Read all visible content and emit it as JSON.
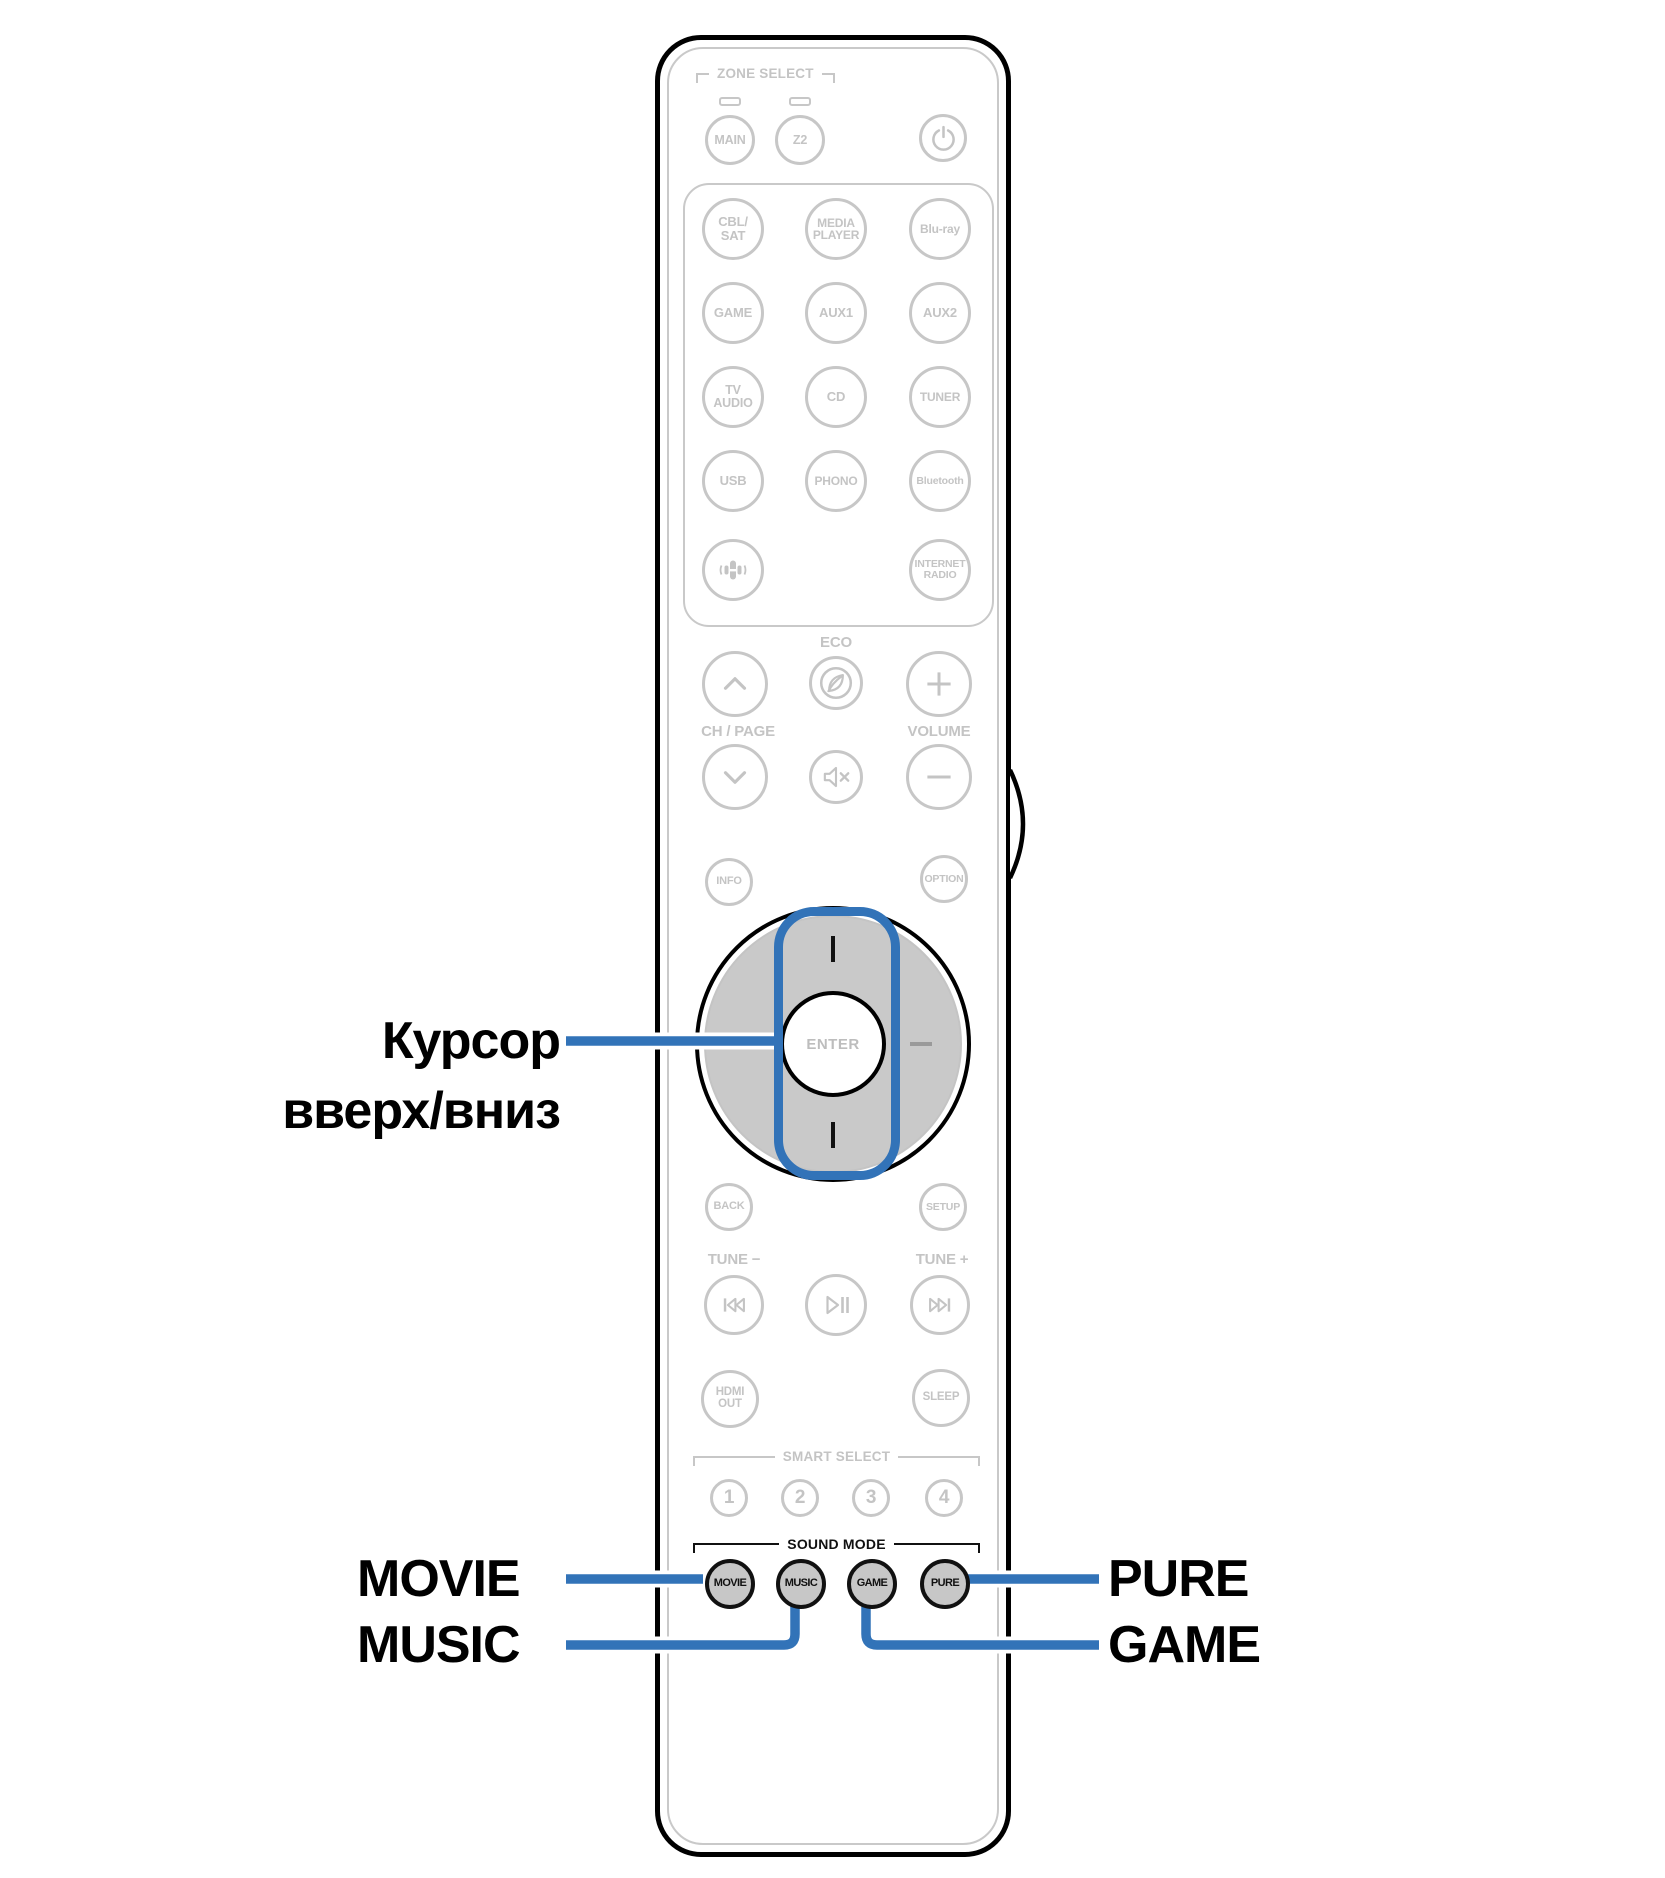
{
  "colors": {
    "callout_blue": "#3273b8",
    "artwork_gray": "#c4c4c4",
    "pad_fill": "#c9c9c9",
    "sound_button_fill": "#c7c7c7",
    "outline_black": "#000000"
  },
  "callouts": {
    "cursor_line1": "Курсор",
    "cursor_line2": "вверх/вниз",
    "movie": "MOVIE",
    "music": "MUSIC",
    "pure": "PURE",
    "game": "GAME"
  },
  "remote": {
    "zone": {
      "header": "ZONE SELECT",
      "main": "MAIN",
      "z2": "Z2"
    },
    "sources": [
      {
        "line1": "CBL/",
        "line2": "SAT"
      },
      {
        "line1": "MEDIA",
        "line2": "PLAYER"
      },
      {
        "line1": "Blu-ray"
      },
      {
        "line1": "GAME"
      },
      {
        "line1": "AUX1"
      },
      {
        "line1": "AUX2"
      },
      {
        "line1": "TV",
        "line2": "AUDIO"
      },
      {
        "line1": "CD"
      },
      {
        "line1": "TUNER"
      },
      {
        "line1": "USB"
      },
      {
        "line1": "PHONO"
      },
      {
        "line1": "Bluetooth"
      },
      {
        "line1": "INTERNET",
        "line2": "RADIO"
      }
    ],
    "controls": {
      "eco_label": "ECO",
      "ch_page_label": "CH / PAGE",
      "volume_label": "VOLUME",
      "info": "INFO",
      "option": "OPTION",
      "enter": "ENTER",
      "back": "BACK",
      "setup": "SETUP",
      "tune_minus": "TUNE −",
      "tune_plus": "TUNE +",
      "hdmi_line1": "HDMI",
      "hdmi_line2": "OUT",
      "sleep": "SLEEP"
    },
    "smart_select": {
      "header": "SMART SELECT",
      "buttons": [
        "1",
        "2",
        "3",
        "4"
      ]
    },
    "sound_mode": {
      "header": "SOUND MODE",
      "movie": "MOVIE",
      "music": "MUSIC",
      "game": "GAME",
      "pure": "PURE"
    }
  },
  "icons": {
    "power": "power-icon",
    "zone_led": "led-indicator",
    "voice": "speaker-voice-icon",
    "eco": "eco-leaf-icon",
    "channel_up": "chevron-up-icon",
    "channel_down": "chevron-down-icon",
    "volume_up": "plus-icon",
    "volume_down": "minus-icon",
    "mute": "mute-icon",
    "skip_back": "skip-back-icon",
    "play_pause": "play-pause-icon",
    "skip_forward": "skip-forward-icon"
  }
}
